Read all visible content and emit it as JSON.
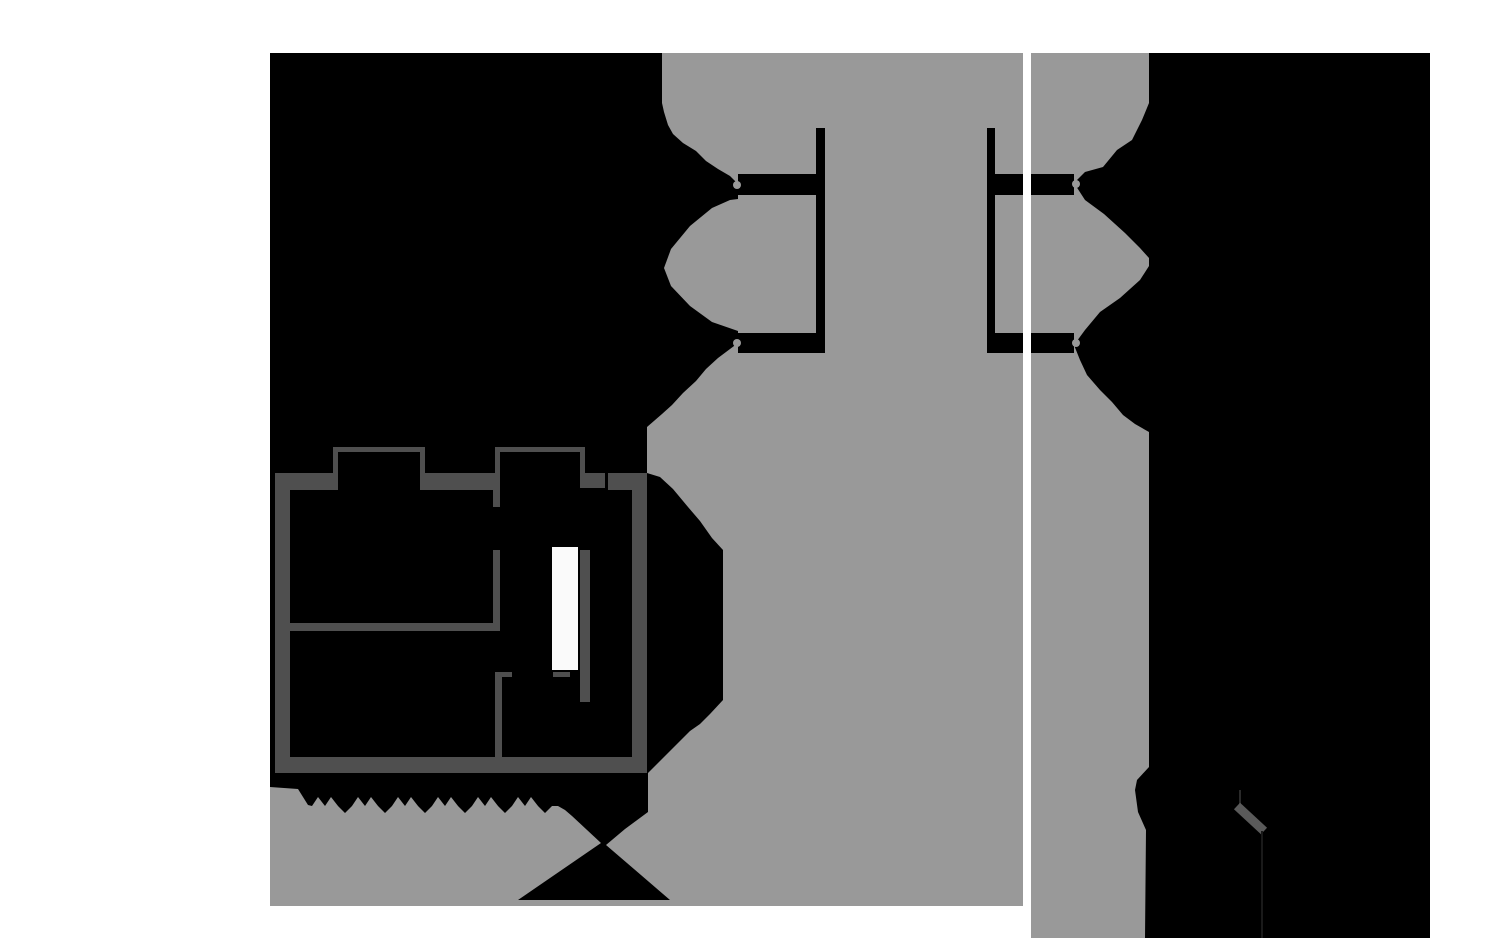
{
  "view": {
    "width": 1500,
    "height": 938,
    "background": "#ffffff"
  },
  "colors": {
    "page_bg": "#ffffff",
    "canvas_bg": "#000000",
    "free_space": "#999999",
    "wall": "#4f4f4f",
    "door_panel": "#fafafa",
    "divider": "#ffffff",
    "faint_line_upper": "#2a2a2a",
    "faint_line_lower": "#1a1a1a",
    "diag_wall": "#5a5a5a"
  },
  "panels": {
    "left": {
      "name": "left-map-panel",
      "x": 270,
      "y": 53,
      "w": 753,
      "h": 853
    },
    "right": {
      "name": "right-map-panel",
      "x": 1031,
      "y": 53,
      "w": 399,
      "h": 885
    },
    "divider": {
      "name": "panel-divider",
      "x": 1023,
      "y": 53,
      "w": 8,
      "h": 885
    }
  },
  "shapes": [
    {
      "name": "left-panel-background",
      "type": "rect",
      "x": 270,
      "y": 53,
      "w": 753,
      "h": 853,
      "fill": "canvas_bg"
    },
    {
      "name": "right-panel-background",
      "type": "rect",
      "x": 1031,
      "y": 53,
      "w": 399,
      "h": 885,
      "fill": "canvas_bg"
    },
    {
      "name": "left-free-space-mask",
      "type": "polygon",
      "fill": "free_space",
      "points": "662,53 1023,53 1023,906 270,906 270,787 298,789 308,805 312,806 318,797 325,806 331,797 338,806 345,813 352,806 358,797 365,806 371,797 378,806 385,813 392,806 398,797 405,806 411,797 418,806 425,813 432,806 438,797 445,806 451,797 458,806 465,813 472,806 478,797 485,806 491,797 498,806 505,813 512,806 518,797 525,806 531,797 538,806 545,813 552,806 558,806 565,810 572,816 601,843 518,900 670,900 606,845 625,829 648,812 648,773 690,731 700,724 710,714 723,700 723,550 712,538 700,521 688,507 673,489 660,477 647,473 647,427 662,414 672,405 683,393 696,381 706,369 718,358 730,349 738,343 738,184 730,176 718,169 706,161 696,151 683,143 673,134 668,125 664,112 662,103"
    },
    {
      "name": "left-free-space-lobe",
      "type": "polygon",
      "fill": "free_space",
      "points": "738,199 738,331 712,322 690,306 671,286 664,268 671,249 690,226 712,208 730,200"
    },
    {
      "name": "left-corridor-bracket",
      "type": "polygon",
      "fill": "canvas_bg",
      "points": "816,128 825,128 825,353 738,353 738,333 816,333 816,195 738,195 738,174 816,174"
    },
    {
      "name": "right-corridor-bracket",
      "type": "polygon",
      "fill": "canvas_bg",
      "points": "987,128 995,128 995,174 1023,174 1023,195 995,195 995,333 1023,333 1023,353 995,353 987,353"
    },
    {
      "name": "left-neck-nub-top",
      "type": "circle",
      "cx": 737,
      "cy": 185,
      "r": 4,
      "fill": "free_space"
    },
    {
      "name": "left-neck-nub-bottom",
      "type": "circle",
      "cx": 737,
      "cy": 343,
      "r": 4,
      "fill": "free_space"
    },
    {
      "name": "right-free-space-mask",
      "type": "polygon",
      "fill": "free_space",
      "points": "1031,53 1149,53 1149,767 1137,780 1135,790 1138,812 1146,830 1145,938 1031,938"
    },
    {
      "name": "right-upper-wedge",
      "type": "polygon",
      "fill": "canvas_bg",
      "points": "1149,103 1142,120 1132,140 1117,150 1103,167 1085,172 1074,183 1085,200 1104,214 1125,233 1140,248 1149,258"
    },
    {
      "name": "right-lower-wedge",
      "type": "polygon",
      "fill": "canvas_bg",
      "points": "1149,266 1140,280 1120,298 1100,312 1085,330 1074,345 1080,360 1087,375 1100,390 1112,402 1123,415 1135,424 1149,432"
    },
    {
      "name": "right-corridor-arm-top",
      "type": "rect",
      "x": 1031,
      "y": 174,
      "w": 43,
      "h": 21,
      "fill": "canvas_bg"
    },
    {
      "name": "right-corridor-arm-bottom",
      "type": "rect",
      "x": 1031,
      "y": 333,
      "w": 43,
      "h": 20,
      "fill": "canvas_bg"
    },
    {
      "name": "right-neck-nub-top",
      "type": "circle",
      "cx": 1076,
      "cy": 184,
      "r": 4,
      "fill": "free_space"
    },
    {
      "name": "right-neck-nub-bottom",
      "type": "circle",
      "cx": 1076,
      "cy": 343,
      "r": 4,
      "fill": "free_space"
    },
    {
      "name": "wall-outer-left",
      "type": "rect",
      "x": 275,
      "y": 473,
      "w": 15,
      "h": 300,
      "fill": "wall"
    },
    {
      "name": "wall-top-left",
      "type": "rect",
      "x": 275,
      "y": 473,
      "w": 63,
      "h": 17,
      "fill": "wall"
    },
    {
      "name": "bump1-wall-left",
      "type": "rect",
      "x": 333,
      "y": 447,
      "w": 5,
      "h": 26,
      "fill": "wall"
    },
    {
      "name": "bump1-wall-top",
      "type": "rect",
      "x": 333,
      "y": 447,
      "w": 92,
      "h": 5,
      "fill": "wall"
    },
    {
      "name": "bump1-wall-right",
      "type": "rect",
      "x": 420,
      "y": 447,
      "w": 5,
      "h": 26,
      "fill": "wall"
    },
    {
      "name": "wall-top-mid",
      "type": "rect",
      "x": 420,
      "y": 473,
      "w": 80,
      "h": 17,
      "fill": "wall"
    },
    {
      "name": "bump2-wall-left",
      "type": "rect",
      "x": 495,
      "y": 447,
      "w": 5,
      "h": 26,
      "fill": "wall"
    },
    {
      "name": "bump2-wall-top",
      "type": "rect",
      "x": 495,
      "y": 447,
      "w": 90,
      "h": 5,
      "fill": "wall"
    },
    {
      "name": "bump2-wall-right",
      "type": "rect",
      "x": 580,
      "y": 447,
      "w": 5,
      "h": 26,
      "fill": "wall"
    },
    {
      "name": "wall-top-chunk",
      "type": "rect",
      "x": 580,
      "y": 473,
      "w": 25,
      "h": 15,
      "fill": "wall"
    },
    {
      "name": "wall-top-right",
      "type": "rect",
      "x": 608,
      "y": 473,
      "w": 39,
      "h": 17,
      "fill": "wall"
    },
    {
      "name": "wall-outer-right",
      "type": "rect",
      "x": 632,
      "y": 473,
      "w": 15,
      "h": 300,
      "fill": "wall"
    },
    {
      "name": "wall-outer-bottom",
      "type": "rect",
      "x": 275,
      "y": 757,
      "w": 372,
      "h": 16,
      "fill": "wall"
    },
    {
      "name": "wall-mid-horizontal",
      "type": "rect",
      "x": 290,
      "y": 623,
      "w": 207,
      "h": 8,
      "fill": "wall"
    },
    {
      "name": "wall-vertical-stub",
      "type": "rect",
      "x": 493,
      "y": 490,
      "w": 7,
      "h": 17,
      "fill": "wall"
    },
    {
      "name": "wall-vertical-mid",
      "type": "rect",
      "x": 493,
      "y": 550,
      "w": 7,
      "h": 81,
      "fill": "wall"
    },
    {
      "name": "wall-L-vertical",
      "type": "rect",
      "x": 495,
      "y": 672,
      "w": 7,
      "h": 85,
      "fill": "wall"
    },
    {
      "name": "wall-L-stub",
      "type": "rect",
      "x": 495,
      "y": 672,
      "w": 17,
      "h": 5,
      "fill": "wall"
    },
    {
      "name": "wall-door-stub",
      "type": "rect",
      "x": 553,
      "y": 672,
      "w": 17,
      "h": 5,
      "fill": "wall"
    },
    {
      "name": "wall-beside-door",
      "type": "rect",
      "x": 580,
      "y": 550,
      "w": 10,
      "h": 152,
      "fill": "wall"
    },
    {
      "name": "door-highlight-panel",
      "type": "rect",
      "x": 552,
      "y": 547,
      "w": 26,
      "h": 123,
      "fill": "door_panel"
    },
    {
      "name": "right-faint-wall-upper",
      "type": "rect",
      "x": 1239,
      "y": 790,
      "w": 2,
      "h": 16,
      "fill": "faint_line_upper"
    },
    {
      "name": "right-diagonal-wall",
      "type": "line",
      "x1": 1237,
      "y1": 806,
      "x2": 1264,
      "y2": 831,
      "stroke": "diag_wall",
      "width": 9
    },
    {
      "name": "right-faint-wall-lower",
      "type": "rect",
      "x": 1261,
      "y": 831,
      "w": 2,
      "h": 107,
      "fill": "faint_line_lower"
    }
  ]
}
